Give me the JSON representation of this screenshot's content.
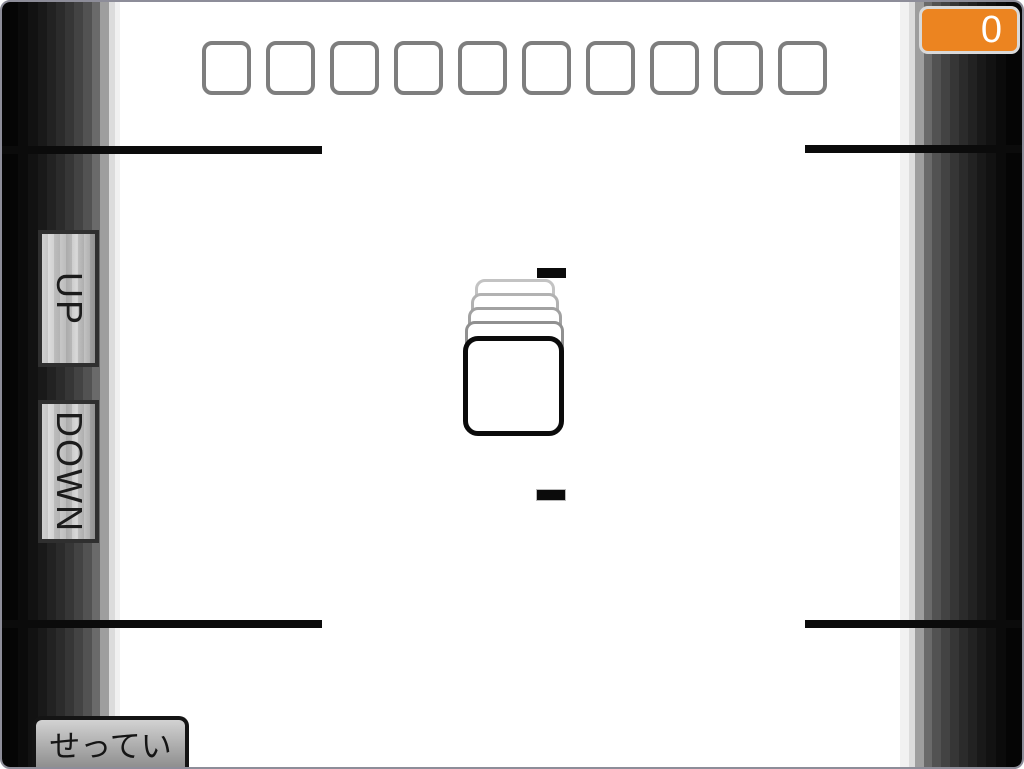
{
  "app": {
    "type": "card-game-screen"
  },
  "colors": {
    "accent": "#EC8420",
    "badge-border": "#D9D9D9",
    "line": "#0B0B0B",
    "slot-border": "#7E7E7E",
    "button-border": "#2F2F2F"
  },
  "score_badge": {
    "value": "0"
  },
  "card_slots": {
    "count": 10
  },
  "side_controls": {
    "up_label": "UP",
    "down_label": "DOWN"
  },
  "settings_button": {
    "label": "せってい"
  },
  "card_stack": {
    "ghost_layers": 4
  }
}
